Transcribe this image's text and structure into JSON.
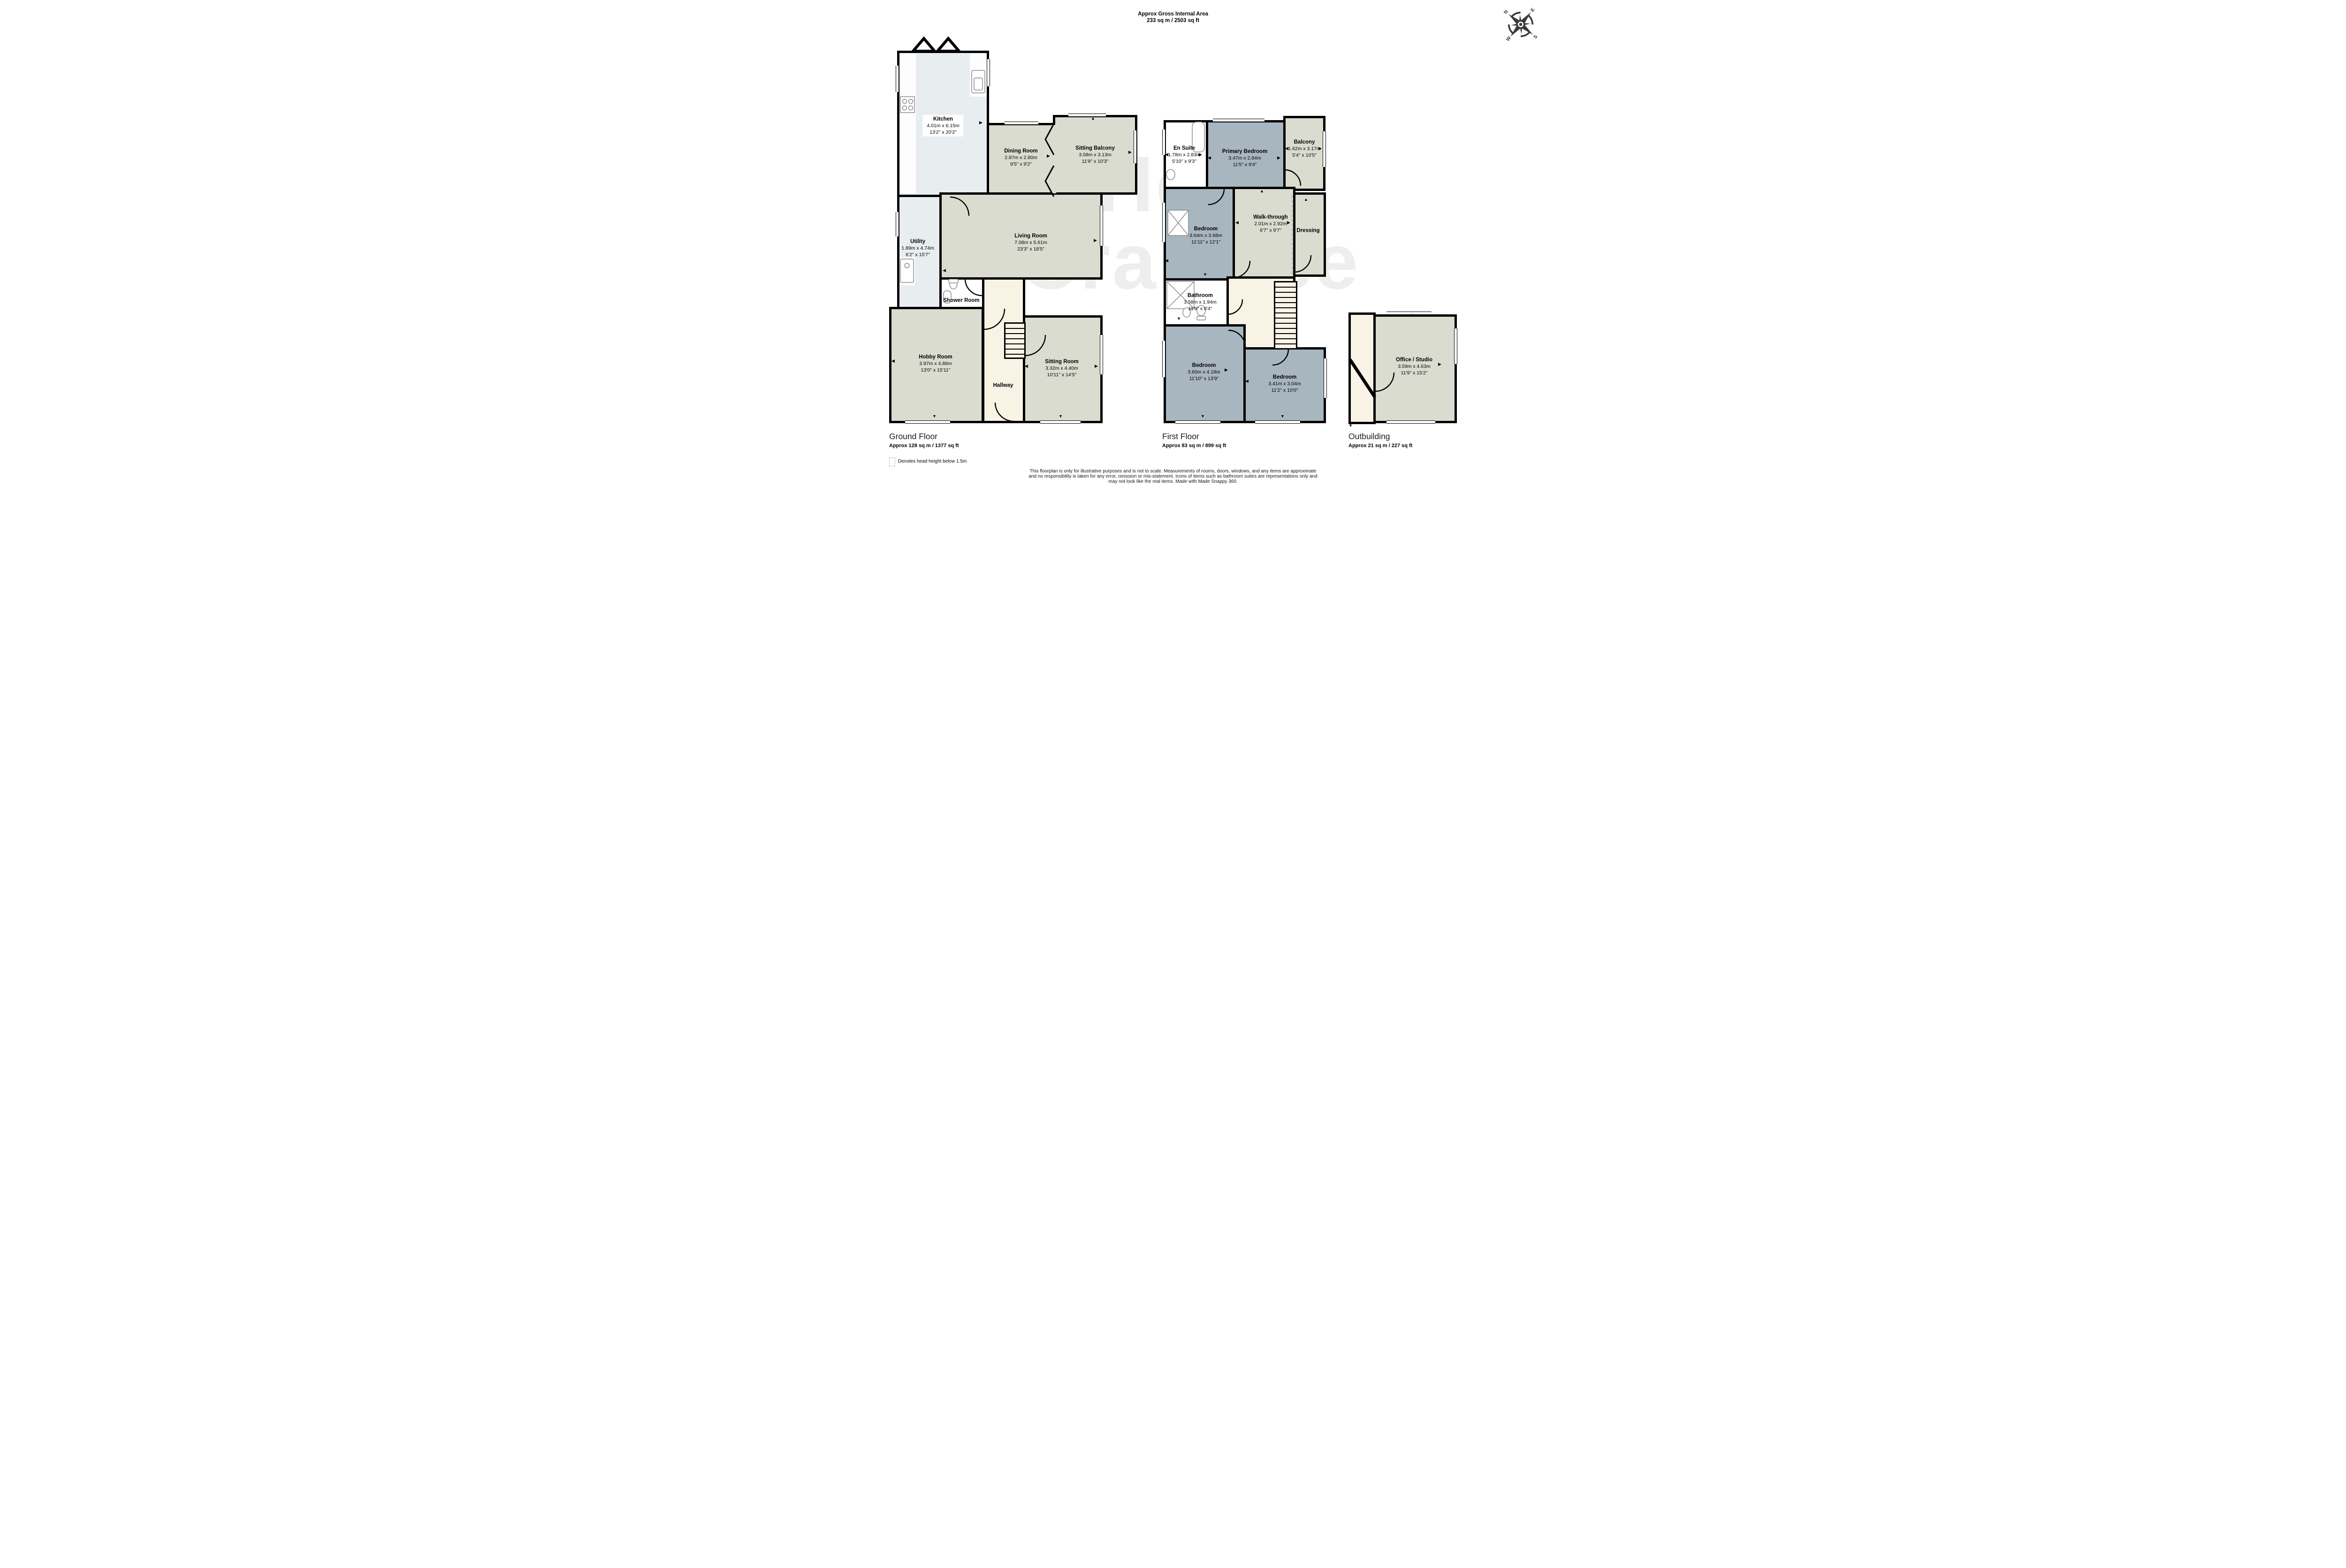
{
  "header": {
    "title_line1": "Approx Gross Internal Area",
    "title_line2": "233 sq m / 2503 sq ft"
  },
  "watermark": {
    "line1": "Hern",
    "line2": "Crabtree"
  },
  "compass": {
    "n": "N",
    "e": "E",
    "s": "S",
    "w": "W"
  },
  "floors": {
    "ground": {
      "name": "Ground Floor",
      "area": "Approx 128 sq m / 1377 sq ft"
    },
    "first": {
      "name": "First Floor",
      "area": "Approx 83 sq m / 899 sq ft"
    },
    "outbuilding": {
      "name": "Outbuilding",
      "area": "Approx 21 sq m / 227 sq ft"
    }
  },
  "rooms": {
    "kitchen": {
      "name": "Kitchen",
      "metric": "4.01m x 6.15m",
      "imperial": "13'2\" x 20'2\""
    },
    "dining": {
      "name": "Dining Room",
      "metric": "2.87m x 2.80m",
      "imperial": "9'5\" x 9'2\""
    },
    "sitting_balcony": {
      "name": "Sitting Balcony",
      "metric": "3.58m x 3.13m",
      "imperial": "11'9\" x 10'3\""
    },
    "utility": {
      "name": "Utility",
      "metric": "1.89m x 4.74m",
      "imperial": "6'2\" x 15'7\""
    },
    "living": {
      "name": "Living Room",
      "metric": "7.08m x 5.61m",
      "imperial": "23'3\" x 18'5\""
    },
    "shower": {
      "name": "Shower Room"
    },
    "hobby": {
      "name": "Hobby Room",
      "metric": "3.97m x 4.86m",
      "imperial": "13'0\" x 15'11\""
    },
    "hallway": {
      "name": "Hallway"
    },
    "sitting_room": {
      "name": "Sitting Room",
      "metric": "3.32m x 4.40m",
      "imperial": "10'11\" x 14'5\""
    },
    "ensuite": {
      "name": "En Suite",
      "metric": "1.78m x 2.83m",
      "imperial": "5'10\" x 9'3\""
    },
    "primary": {
      "name": "Primary Bedroom",
      "metric": "3.47m x 2.84m",
      "imperial": "11'5\" x 9'4\""
    },
    "balcony": {
      "name": "Balcony",
      "metric": "1.62m x 3.17m",
      "imperial": "5'4\" x 10'5\""
    },
    "bedroom1": {
      "name": "Bedroom",
      "metric": "3.64m x 3.68m",
      "imperial": "11'11\" x 12'1\""
    },
    "walkthrough": {
      "name": "Walk-through",
      "metric": "2.01m x 2.92m",
      "imperial": "6'7\" x 9'7\""
    },
    "dressing": {
      "name": "Dressing"
    },
    "bathroom": {
      "name": "Bathroom",
      "metric": "3.58m x 1.94m",
      "imperial": "11'9\" x 6'4\""
    },
    "bedroom2": {
      "name": "Bedroom",
      "metric": "3.60m x 4.18m",
      "imperial": "11'10\" x 13'9\""
    },
    "bedroom3": {
      "name": "Bedroom",
      "metric": "3.41m x 3.04m",
      "imperial": "11'2\" x 10'0\""
    },
    "office": {
      "name": "Office / Studio",
      "metric": "3.59m x 4.63m",
      "imperial": "11'9\" x 15'2\""
    }
  },
  "legend": {
    "text": "Denotes head height below 1.5m"
  },
  "disclaimer": {
    "line1": "This floorplan is only for illustrative purposes and is not to scale. Measurements of rooms, doors, windows, and any items are approximate",
    "line2": "and no responsibility is taken for any error, omission or mis-statement. Icons of items such as bathroom suites are representations only and",
    "line3": "may not look like the real items. Made with Made Snappy 360."
  },
  "icons": {
    "up": "▲",
    "down": "▼",
    "left": "◀",
    "right": "▶"
  },
  "colors": {
    "room_green": "#dbdcd0",
    "room_blue": "#a8b6c0",
    "room_lightblue": "#e8edf0",
    "hall_cream": "#f8f3e5",
    "room_white": "#ffffff",
    "wall": "#000000"
  }
}
